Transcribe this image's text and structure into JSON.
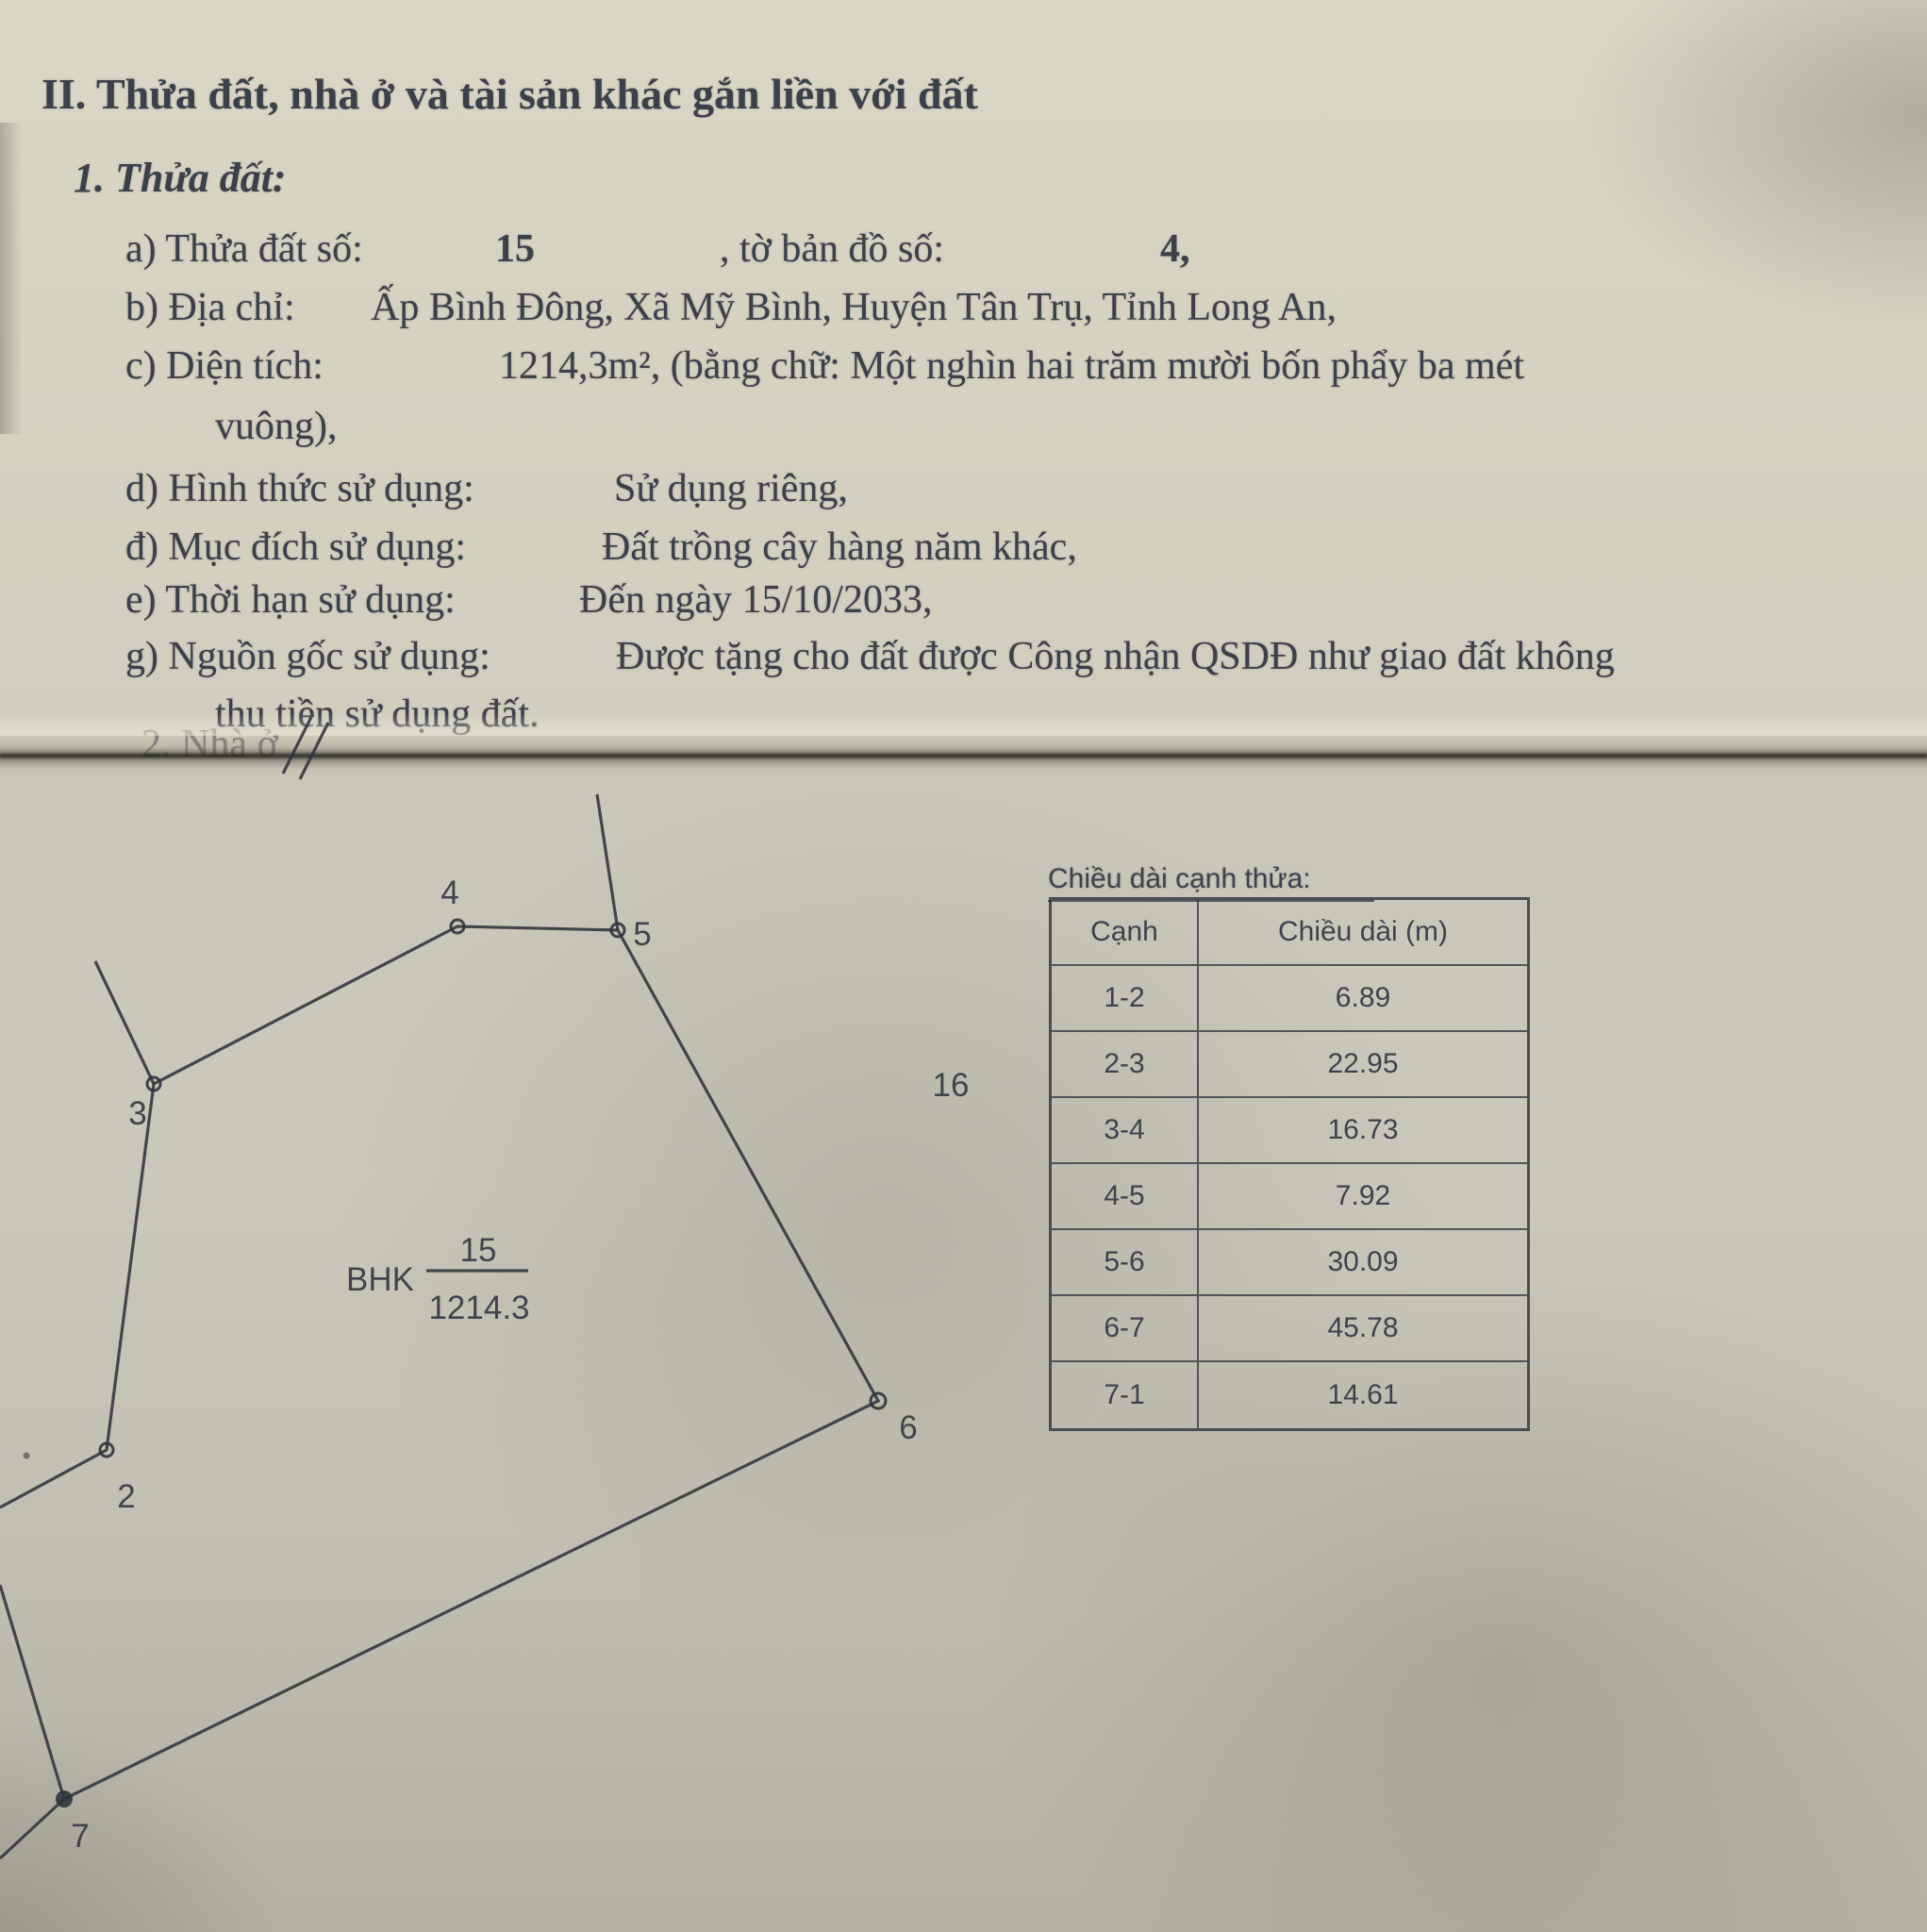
{
  "document": {
    "section_title": "II. Thửa đất, nhà ở và tài sản khác gắn liền với đất",
    "subsection_title": "1. Thửa đất:",
    "cut_off_text": "2. Nhà ở",
    "items": {
      "a_label": "a) Thửa đất số:",
      "a_value": "15",
      "a_label2": ", tờ bản đồ số:",
      "a_value2": "4,",
      "b_label": "b) Địa chỉ:",
      "b_value": "Ấp Bình Đông, Xã Mỹ Bình, Huyện Tân Trụ, Tỉnh Long An,",
      "c_label": "c) Diện tích:",
      "c_value": "1214,3m², (bằng chữ: Một nghìn hai trăm mười bốn phẩy ba mét",
      "c_value_cont": "vuông),",
      "d_label": "d) Hình thức sử dụng:",
      "d_value": "Sử dụng riêng,",
      "dd_label": "đ) Mục đích sử dụng:",
      "dd_value": "Đất trồng cây hàng năm khác,",
      "e_label": "e) Thời hạn sử dụng:",
      "e_value": "Đến ngày 15/10/2033,",
      "g_label": "g) Nguồn gốc sử dụng:",
      "g_value": "Được tặng cho đất được Công nhận QSDĐ như giao đất không",
      "g_value_cont": "thu tiền sử dụng đất."
    }
  },
  "diagram": {
    "parcel_code": "BHK",
    "parcel_number": "15",
    "parcel_area": "1214.3",
    "adjacent_parcel_number": "16",
    "vertex_labels": {
      "v2": "2",
      "v3": "3",
      "v4": "4",
      "v5": "5",
      "v6": "6",
      "v7": "7"
    }
  },
  "edge_table": {
    "title": "Chiều dài cạnh thửa:",
    "columns": [
      "Cạnh",
      "Chiều dài (m)"
    ],
    "rows": [
      {
        "edge": "1-2",
        "length": "6.89"
      },
      {
        "edge": "2-3",
        "length": "22.95"
      },
      {
        "edge": "3-4",
        "length": "16.73"
      },
      {
        "edge": "4-5",
        "length": "7.92"
      },
      {
        "edge": "5-6",
        "length": "30.09"
      },
      {
        "edge": "6-7",
        "length": "45.78"
      },
      {
        "edge": "7-1",
        "length": "14.61"
      }
    ]
  }
}
